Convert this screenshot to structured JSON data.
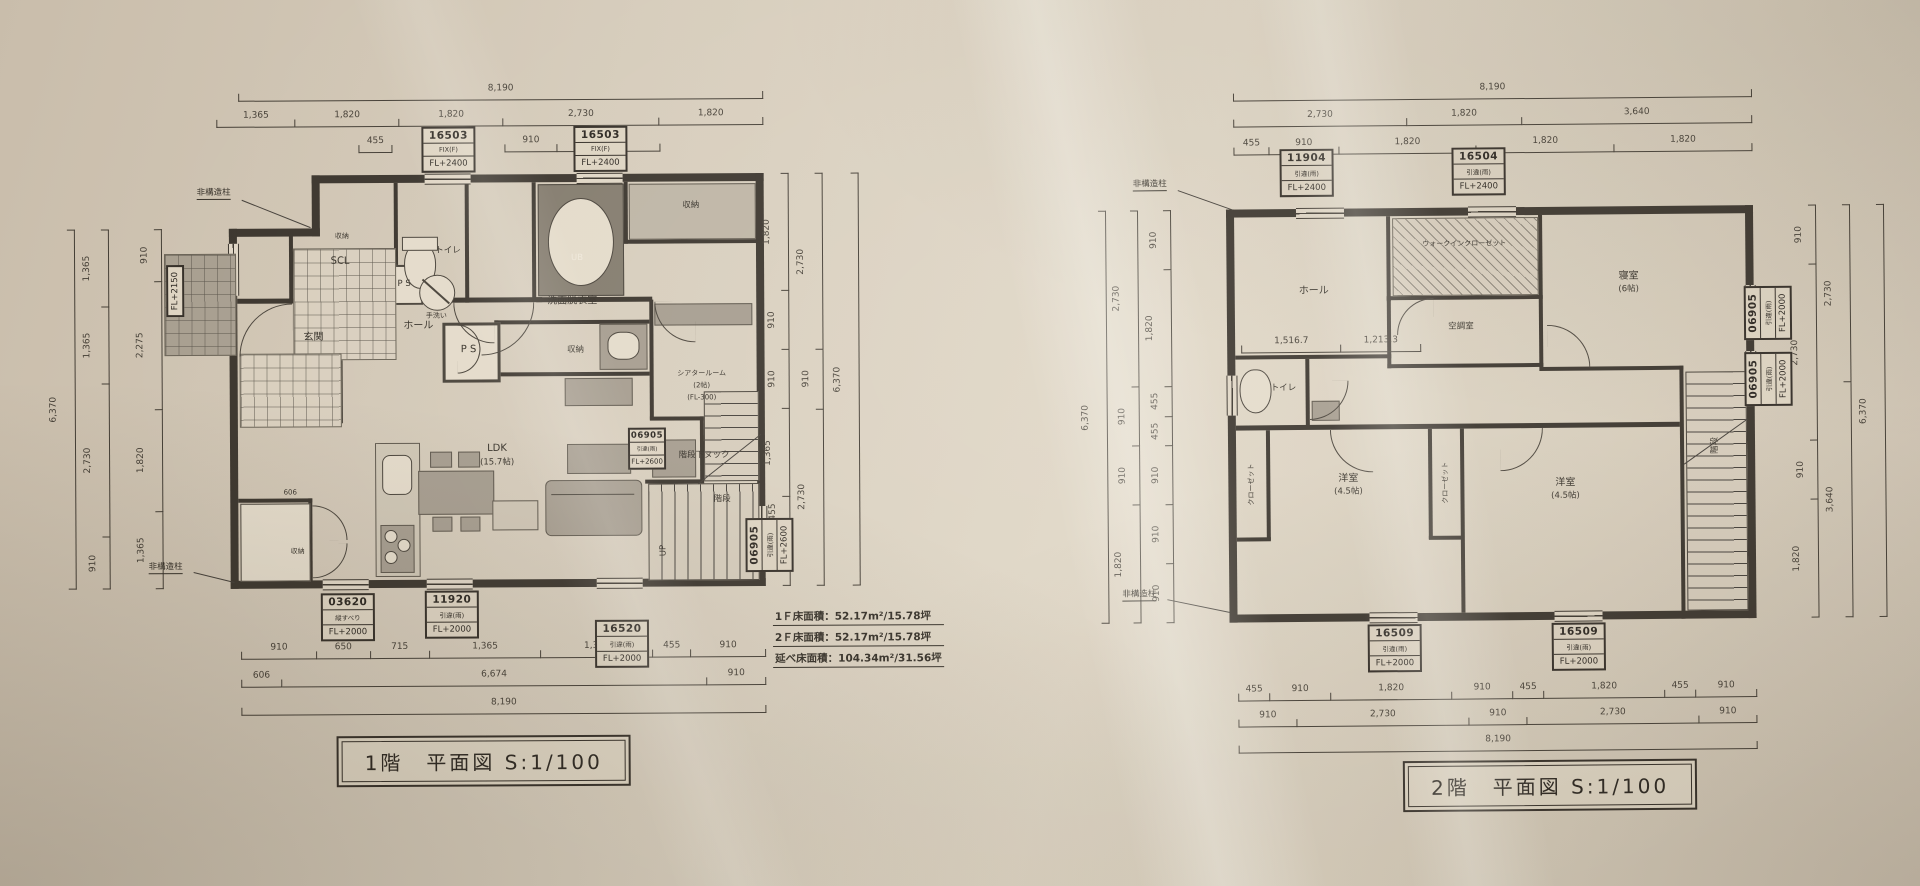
{
  "f1": {
    "title": "1階　平面図 S:1/100",
    "posts": {
      "top": "非構造柱",
      "bottom": "非構造柱"
    },
    "rooms": {
      "storage_top": "収納",
      "scl": "SCL",
      "toilet": "トイレ",
      "hand_wash": "手洗い",
      "ps1": "P S",
      "washroom": "洗面脱衣室",
      "storage_right": "収納",
      "ub": "UB",
      "genkan": "玄関",
      "hall": "ホール",
      "ps2": "P S",
      "storage_mid": "収納",
      "theater1": "シアタールーム",
      "theater2": "(2帖)",
      "theater3": "(FL-300)",
      "nook": "階段下ヌック",
      "stair": "階段",
      "up": "UP",
      "ldk1": "LDK",
      "ldk2": "(15.7帖)",
      "storage_bottom": "収納",
      "dim606": "606"
    },
    "tags": {
      "top1": [
        "16503",
        "FIX(F)",
        "FL+2400"
      ],
      "top2": [
        "16503",
        "FIX(F)",
        "FL+2400"
      ],
      "left": [
        "FL+2150"
      ],
      "stair1": [
        "06905",
        "引違(雨)",
        "FL+2600"
      ],
      "stair2": [
        "06905",
        "引違(雨)",
        "FL+2600"
      ],
      "b1": [
        "03620",
        "縦すべり",
        "FL+2000"
      ],
      "b2": [
        "11920",
        "引違(雨)",
        "FL+2000"
      ],
      "b3": [
        "16520",
        "引違(雨)",
        "FL+2000"
      ]
    },
    "dims": {
      "top_total": [
        "8,190"
      ],
      "top_chain": [
        "1,365",
        "1,820",
        "1,820",
        "2,730",
        "1,820"
      ],
      "top_455": [
        "455"
      ],
      "top_sub": [
        "910",
        "1,820"
      ],
      "left_outer": [
        "6,370"
      ],
      "left_mid": [
        "1,365",
        "1,365",
        "2,730",
        "910"
      ],
      "left_inner": [
        "910",
        "2,275",
        "1,820",
        "1,365"
      ],
      "right_inner": [
        "1,820",
        "910",
        "910",
        "1,365",
        "455",
        "910"
      ],
      "right_mid": [
        "2,730",
        "910",
        "2,730"
      ],
      "right_outer": [
        "6,370"
      ],
      "bottom_r1": [
        "910",
        "650",
        "715",
        "1,365",
        "1,365",
        "455",
        "910"
      ],
      "bottom_r2": [
        "606",
        "6,674",
        "910"
      ],
      "bottom_total": [
        "8,190"
      ]
    },
    "notes": [
      "1Ｆ床面積：52.17m²/15.78坪",
      "2Ｆ床面積：52.17m²/15.78坪",
      "延べ床面積：104.34m²/31.56坪"
    ]
  },
  "f2": {
    "title": "2階　平面図 S:1/100",
    "posts": {
      "top": "非構造柱",
      "bottom": "非構造柱"
    },
    "rooms": {
      "hall": "ホール",
      "wic": "ウォークインクローゼット",
      "bedroom1": "寝室",
      "bedroom2": "(6帖)",
      "aircon": "空調室",
      "toilet": "トイレ",
      "west1a": "洋室",
      "west1b": "(4.5帖)",
      "closet1": "クローゼット",
      "closet2": "クローゼット",
      "west2a": "洋室",
      "west2b": "(4.5帖)",
      "stair": "階段"
    },
    "tags": {
      "top1": [
        "11904",
        "引違(雨)",
        "FL+2400"
      ],
      "top2": [
        "16504",
        "引違(雨)",
        "FL+2400"
      ],
      "right1": [
        "06905",
        "引違(雨)",
        "FL+2000"
      ],
      "right2": [
        "06905",
        "引違(雨)",
        "FL+2000"
      ],
      "b1": [
        "16509",
        "引違(雨)",
        "FL+2000"
      ],
      "b2": [
        "16509",
        "引違(雨)",
        "FL+2000"
      ]
    },
    "dims": {
      "top_total": [
        "8,190"
      ],
      "top_chain": [
        "2,730",
        "1,820",
        "3,640"
      ],
      "top_sub": [
        "455",
        "910",
        "1,820",
        "1,820",
        "1,820"
      ],
      "left_outer": [
        "6,370"
      ],
      "left_mid": [
        "2,730",
        "910",
        "910",
        "1,820"
      ],
      "left_inner": [
        "910",
        "1,820",
        "455",
        "455",
        "910",
        "910",
        "910"
      ],
      "inner_chain": [
        "1,516.7",
        "1,213.3"
      ],
      "right_inner": [
        "910",
        "2,730",
        "910",
        "1,820"
      ],
      "right_mid": [
        "2,730",
        "3,640"
      ],
      "right_outer": [
        "6,370"
      ],
      "bottom_r1": [
        "455",
        "910",
        "1,820",
        "910",
        "455",
        "1,820",
        "455",
        "910"
      ],
      "bottom_r2": [
        "910",
        "2,730",
        "910",
        "2,730",
        "910"
      ],
      "bottom_total": [
        "8,190"
      ]
    }
  }
}
